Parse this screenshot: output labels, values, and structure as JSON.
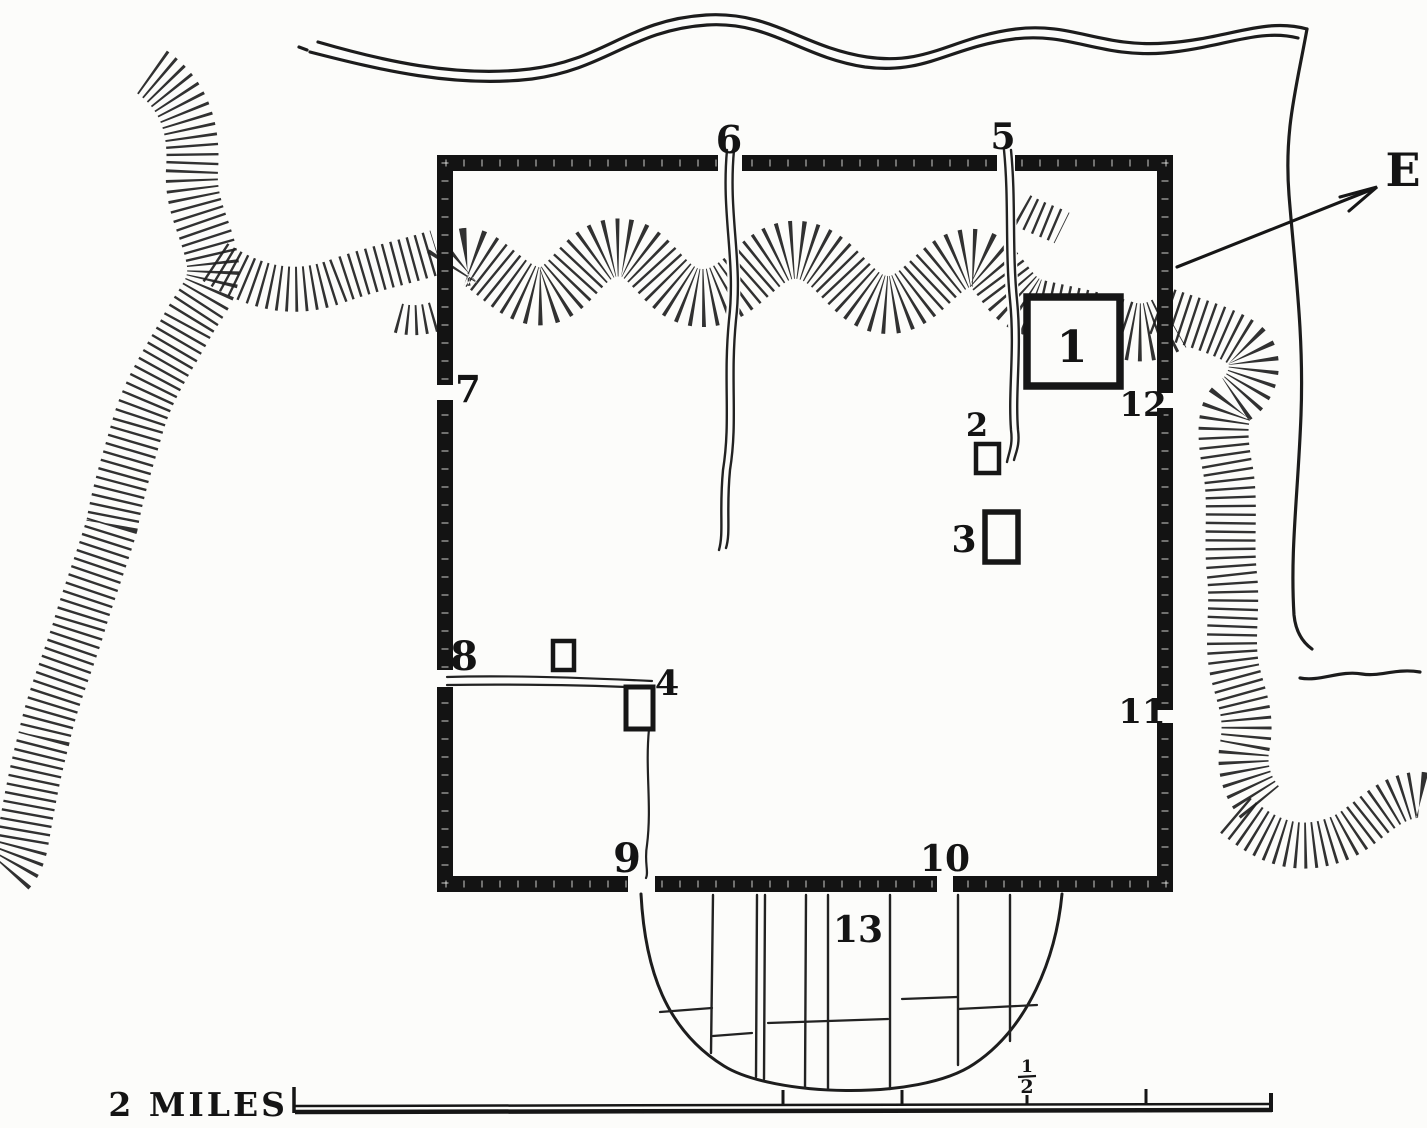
{
  "palette": {
    "ink": "#1a1a1a",
    "paper": "#fcfcfa"
  },
  "compass": {
    "east_label": "E"
  },
  "scale_bar": {
    "label": "2 MILES",
    "half_numerator": "1",
    "half_denominator": "2"
  },
  "numbered_sites": {
    "n1": "1",
    "n2": "2",
    "n3": "3",
    "n4": "4",
    "n5": "5",
    "n6": "6",
    "n7": "7",
    "n8": "8",
    "n9": "9",
    "n10": "10",
    "n11": "11",
    "n12": "12",
    "n13": "13"
  }
}
